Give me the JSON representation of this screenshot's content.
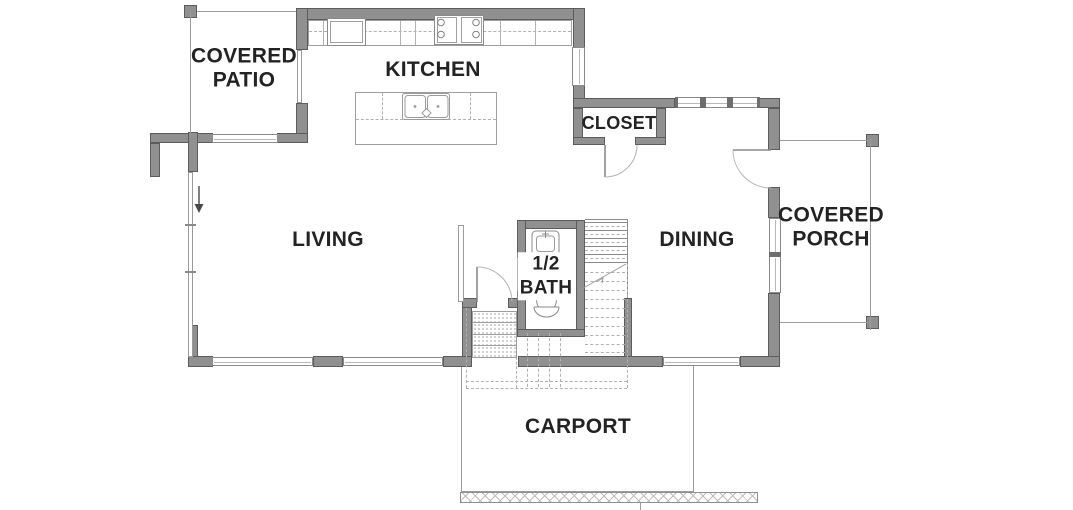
{
  "rooms": {
    "covered_patio": {
      "line1": "COVERED",
      "line2": "PATIO"
    },
    "kitchen": {
      "label": "KITCHEN"
    },
    "closet": {
      "label": "CLOSET"
    },
    "living": {
      "label": "LIVING"
    },
    "dining": {
      "label": "DINING"
    },
    "half_bath": {
      "line1": "1/2",
      "line2": "BATH"
    },
    "covered_porch": {
      "line1": "COVERED",
      "line2": "PORCH"
    },
    "carport": {
      "label": "CARPORT"
    }
  },
  "fixtures": {
    "refrigerator": "refrigerator",
    "range": "range-cooktop",
    "island_sink": "double-basin-sink",
    "bath_sink": "vanity-sink",
    "toilet": "toilet"
  },
  "features": {
    "stairs": "stairs-up",
    "closet_door": "swing-door",
    "entry_door": "swing-door",
    "porch_door": "swing-door",
    "carport_apron": "hatched-curb"
  },
  "colors": {
    "wall": "#909090",
    "wall_outline": "#5c5c5c",
    "thin_line": "#9c9c9c",
    "dashed_line": "#b0b0b0",
    "text": "#232323",
    "background": "#ffffff"
  }
}
